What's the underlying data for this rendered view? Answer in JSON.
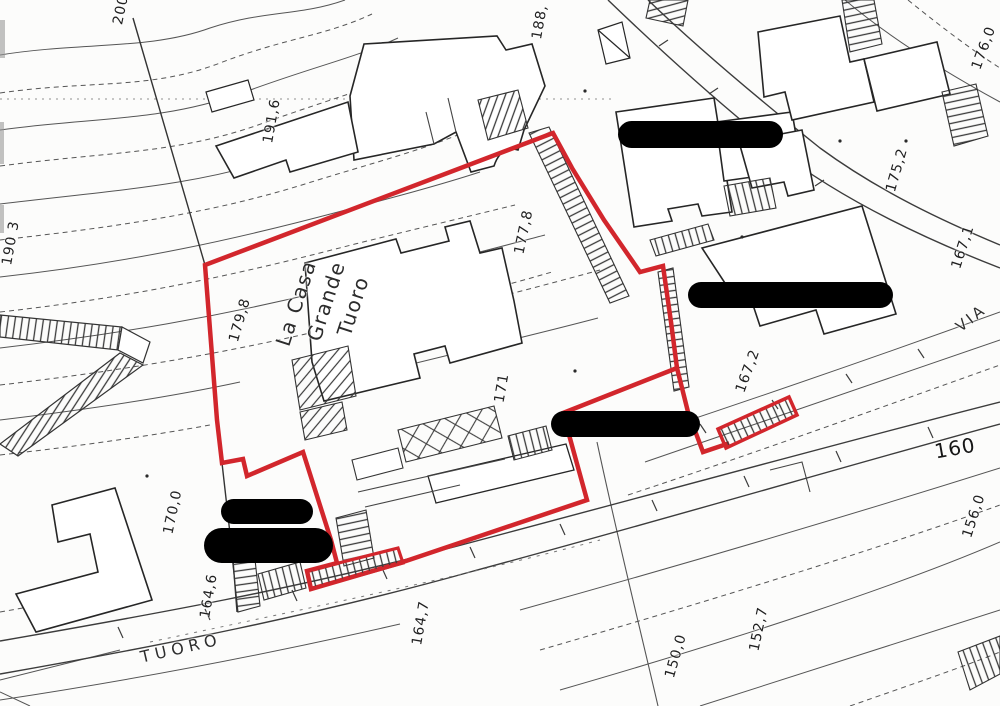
{
  "map": {
    "colors": {
      "boundary_red": "#d2262c",
      "redaction_black": "#000000",
      "line_gray": "#3c3c3c"
    },
    "labels": {
      "l200": "200",
      "l188": "188,",
      "l191_6": "191,6",
      "l190_3": "190 3",
      "l179_8": "179,8",
      "l177_8": "177,8",
      "l171": "171",
      "l175_2": "175,2",
      "l176_0": "176,0",
      "l167_1": "167,1",
      "l167_2": "167,2",
      "l160": "160",
      "l156_0": "156,0",
      "l152_7": "152,7",
      "l150_0": "150,0",
      "l164_7": "164,7",
      "l164_6": "164,6",
      "l170_0": "170,0"
    },
    "streets": {
      "tuoro": "TUORO",
      "via": "VIA"
    },
    "place": {
      "line1": "La Casa",
      "line2": "Grande",
      "line3": "Tuoro"
    }
  }
}
